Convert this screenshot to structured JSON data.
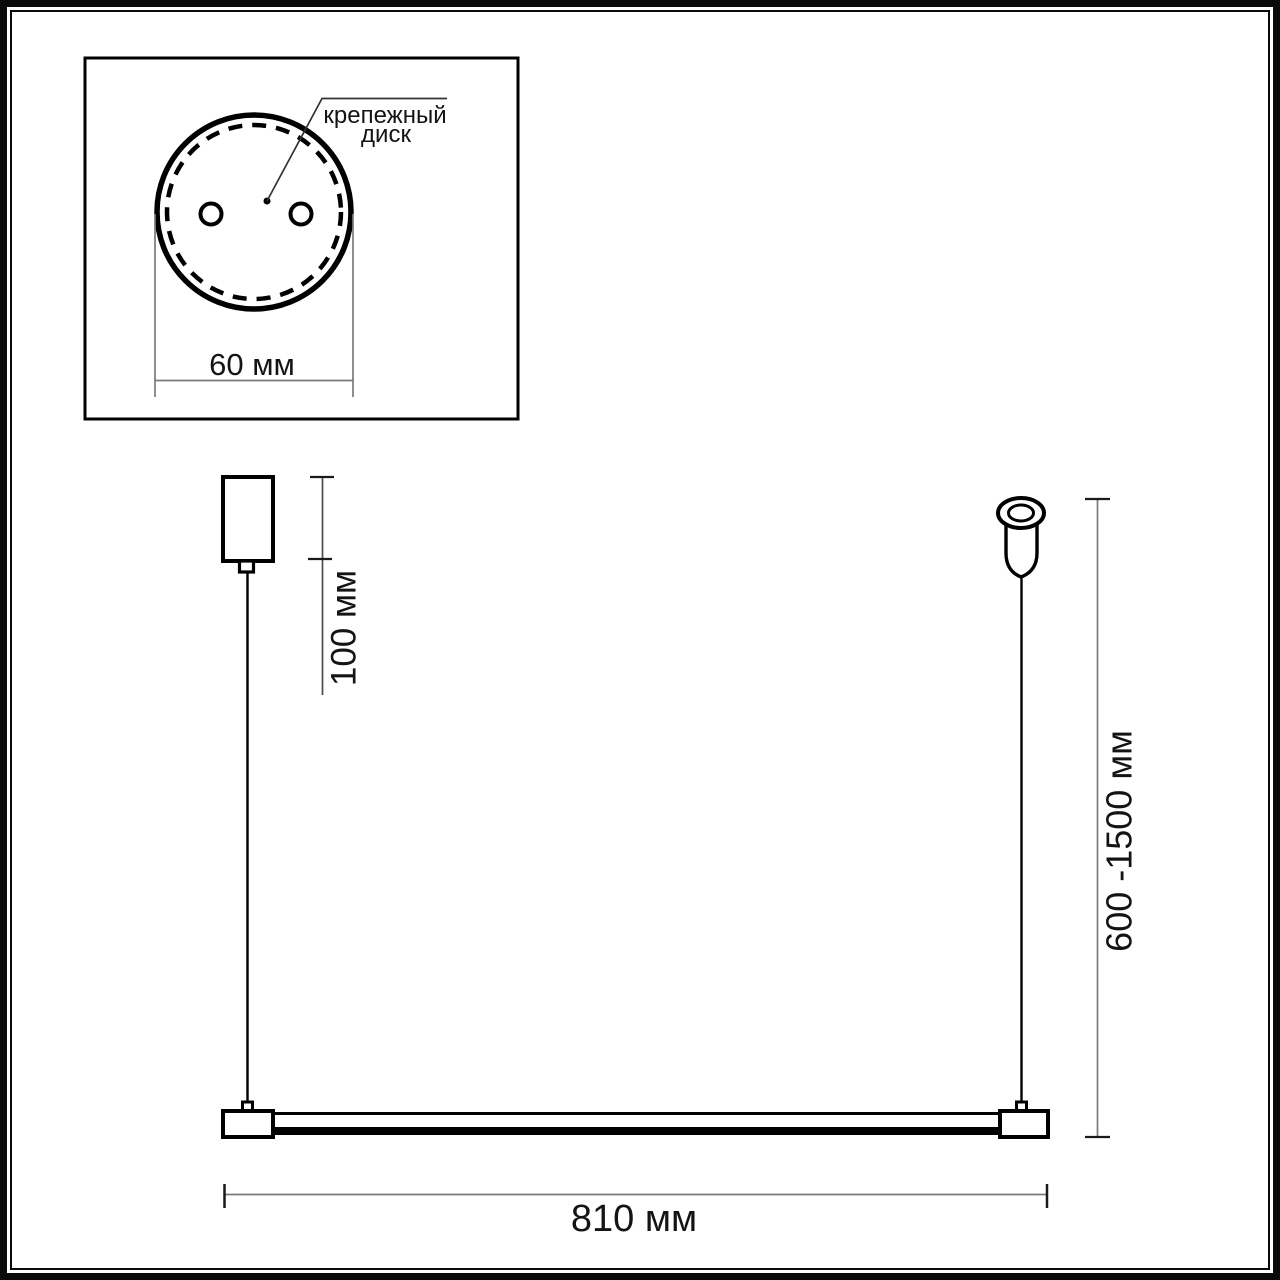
{
  "drawing_type": "pendant light fixture dimensional drawing",
  "inset": {
    "callout_line1": "крепежный",
    "callout_line2": "диск",
    "width_label": "60 мм"
  },
  "dimensions": {
    "canopy": "100 мм",
    "suspension": "600 -1500 мм",
    "bar": "810 мм"
  },
  "colors": {
    "object_line": "#000000",
    "dimension_line": "#7a7a7a",
    "background": "#ffffff",
    "text": "#141414"
  }
}
